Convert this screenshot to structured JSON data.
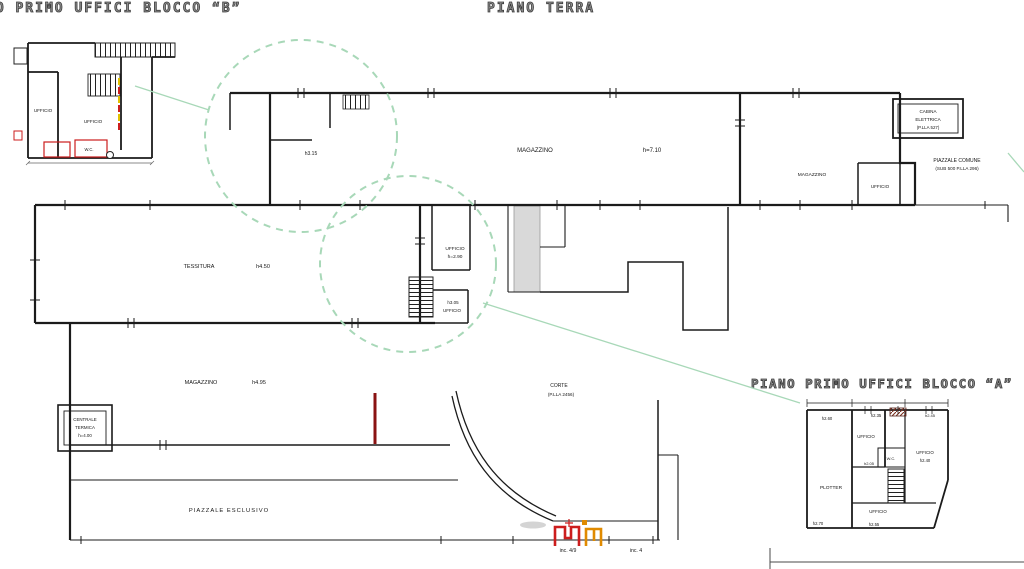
{
  "titles": {
    "block_b": "NO PRIMO UFFICI BLOCCO “B”",
    "center": "PIANO TERRA",
    "block_a": "PIANO PRIMO UFFICI BLOCCO “A”"
  },
  "colors": {
    "line": "#1b1b1b",
    "title_gray": "#3c3c3c",
    "highlight_green": "#a8d8b8",
    "marker_red": "#cc1d1d",
    "marker_orange": "#e08a00",
    "marker_yellow": "#e2c100",
    "section_dark_red": "#8a1212",
    "shaft_gray": "#d9d9d9"
  },
  "block_b": {
    "ufficio_left": "UFFICIO",
    "ufficio_right": "UFFICIO",
    "wc": "W.C."
  },
  "ground": {
    "magazzino_top": "MAGAZZINO",
    "magazzino_top_h": "h=7.10",
    "detail_h": "h3.15",
    "tessitura": "TESSITURA",
    "tessitura_h": "h4.50",
    "ufficio": "UFFICIO",
    "ufficio_h": "h=2.90",
    "ufficio2_h": "h3.05",
    "ufficio2": "UFFICIO",
    "magazzino_low": "MAGAZZINO",
    "magazzino_low_h": "h4.95",
    "corte": "CORTE",
    "corte_sub": "(P.LLA 2456)",
    "centrale": [
      "CENTRALE",
      "TERMICA",
      "h=4.00"
    ],
    "piazzale": "PIAZZALE ESCLUSIVO",
    "magazzino_right": "MAGAZZINO",
    "ufficio_right": "UFFICIO",
    "cabina": [
      "CABINA",
      "ELETTRICA",
      "(P.LLA 527)"
    ],
    "piazzale_comune": [
      "PIAZZALE COMUNE",
      "(SUB 500 P.LLA 296)"
    ],
    "gate_left": "inc. 4/9",
    "gate_right": "inc. 4"
  },
  "block_a": {
    "plotter": "PLOTTER",
    "ufficio_top": "UFFICIO",
    "ufficio_right": "UFFICIO",
    "ufficio_bottom": "UFFICIO",
    "wc": "W.C.",
    "h_260": "h2.60",
    "h_235": "h2.35",
    "h_205": "h2.05",
    "h_240": "h2.40",
    "h_245": "h2.45",
    "h_270": "h2.70",
    "h_255": "h2.55"
  }
}
